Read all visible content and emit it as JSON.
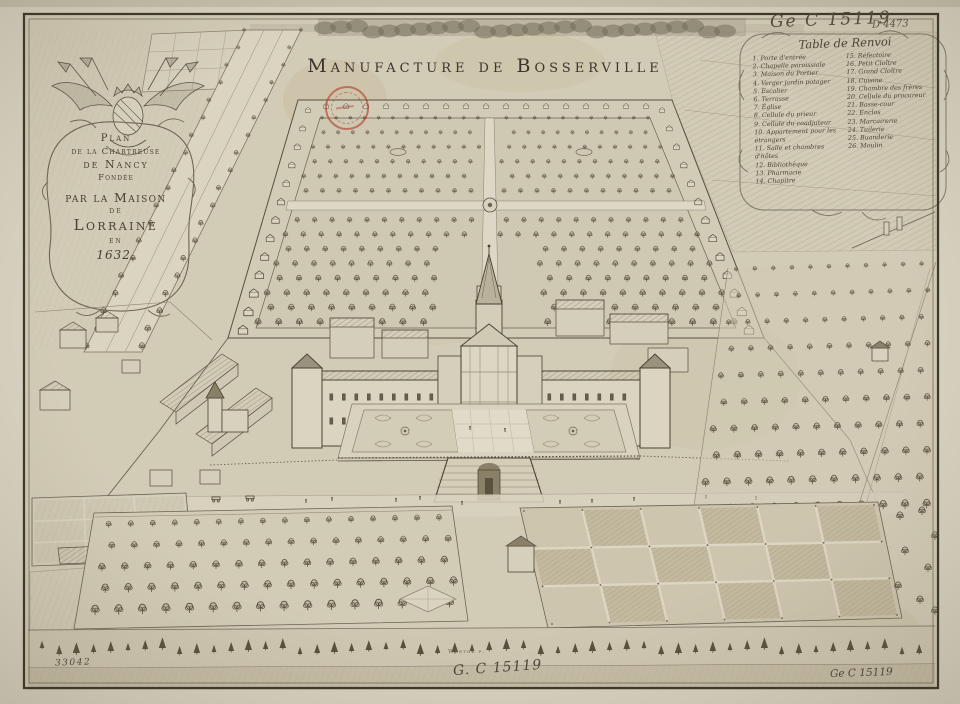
{
  "artwork": {
    "title_display": "Manufacture de Bosserville",
    "cartouche_lines": [
      "Plan",
      "de la Chartreuse",
      "de Nancy",
      "Fondée",
      "par la Maison",
      "de",
      "Lorraine",
      "en",
      "1632."
    ]
  },
  "legend": {
    "title": "Table de Renvoi",
    "left": [
      "1. Porte d'entrée",
      "2. Chapelle paroissiale",
      "3. Maison du Portier",
      "4. Verger jardin potager",
      "5. Escalier",
      "6. Terrasse",
      "7. Église",
      "8. Cellule du prieur",
      "9. Cellule du coadjuteur",
      "10. Appartement pour les étrangers",
      "11. Salle et chambres d'hôtes",
      "12. Bibliothèque",
      "13. Pharmacie",
      "14. Chapitre"
    ],
    "right": [
      "15. Réfectoire",
      "16. Petit Cloître",
      "17. Grand Cloître",
      "18. Cuisine",
      "19. Chambre des frères",
      "20. Cellule du procureur",
      "21. Basse-cour",
      "22. Enclos",
      "23. Marcairerie",
      "24. Tuilerie",
      "25. Buanderie",
      "26. Moulin"
    ]
  },
  "annotations": {
    "top_right_shelfmark": "Ge C 15119",
    "top_right_number": "D 4473",
    "bottom_left_number": "33042",
    "bottom_center_shelfmark": "G. C 15119",
    "bottom_right_shelfmark": "Ge C 15119",
    "engraver_signature": "Werthe f."
  },
  "colors": {
    "paper": "#d7d1c0",
    "ink": "#46402f",
    "stamp_red": "#b53c2a"
  }
}
